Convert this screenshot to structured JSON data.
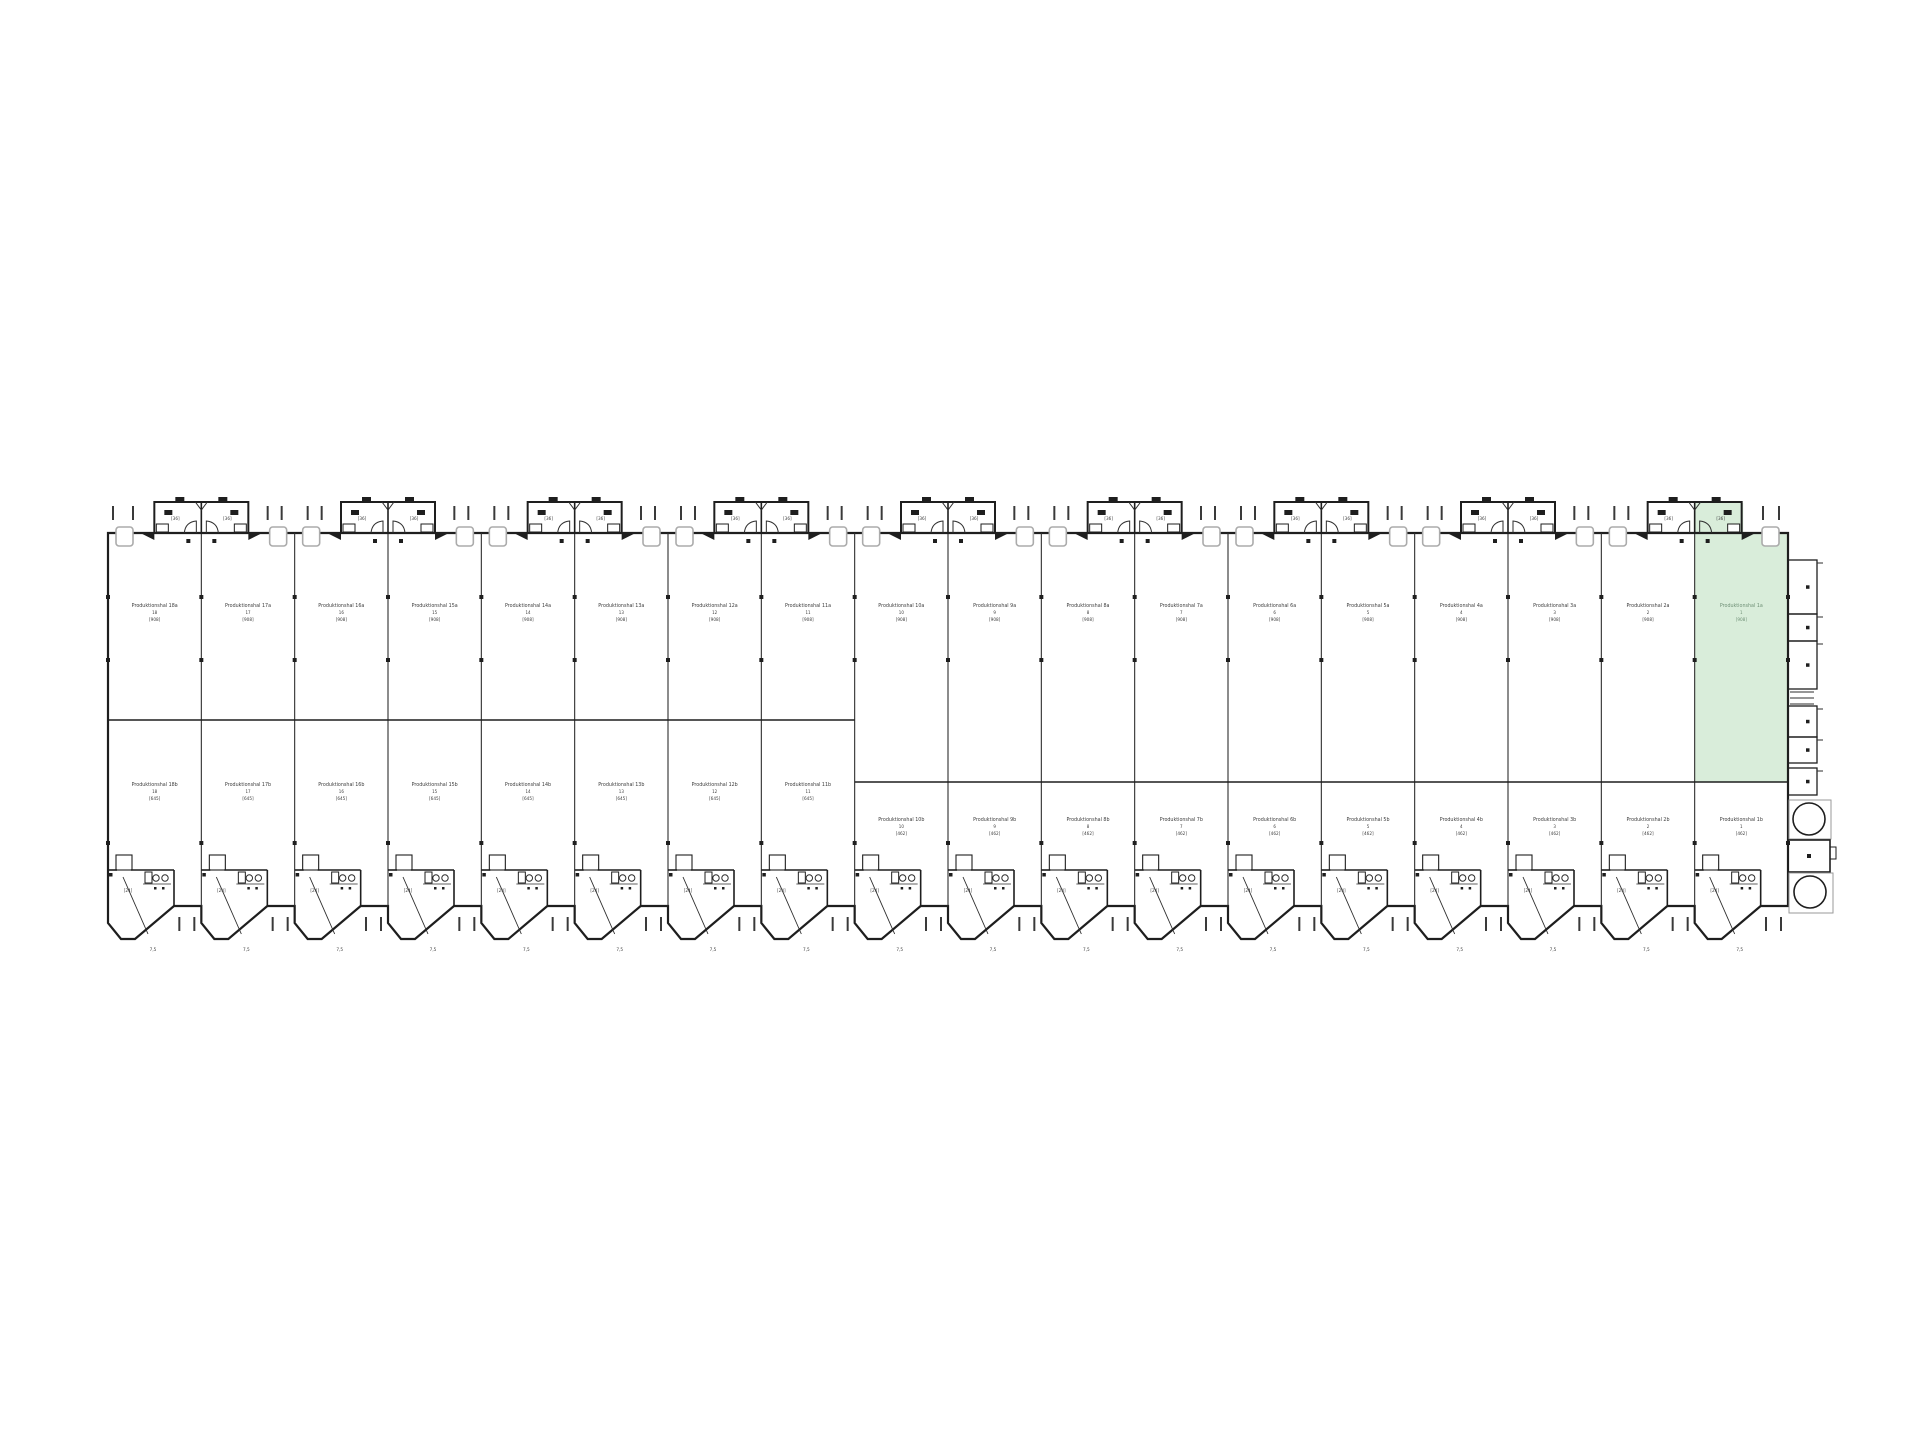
{
  "colors": {
    "line": "#1e1e1e",
    "thin": "#2e2e2e",
    "tick": "#3a3a3a",
    "canopy": "#ababab",
    "tank": "#9a9a9a",
    "text": "#3c3c3c",
    "highlight": "#d9edda",
    "highlight_text": "#6f9076",
    "background": "#ffffff"
  },
  "plan": {
    "highlighted_unit_index": 17,
    "modules": [
      {
        "left_label": "[36]",
        "right_label": "[36]"
      },
      {
        "left_label": "[36]",
        "right_label": "[36]"
      },
      {
        "left_label": "[36]",
        "right_label": "[36]"
      },
      {
        "left_label": "[36]",
        "right_label": "[36]"
      },
      {
        "left_label": "[36]",
        "right_label": "[36]"
      },
      {
        "left_label": "[36]",
        "right_label": "[36]"
      },
      {
        "left_label": "[36]",
        "right_label": "[36]"
      },
      {
        "left_label": "[36]",
        "right_label": "[36]"
      },
      {
        "left_label": "[36]",
        "right_label": "[36]"
      }
    ],
    "units": [
      {
        "top_name": "Produktionshal 18a",
        "top_no": "18",
        "top_area": "[908]",
        "bottom_name": "Produktionshal 18b",
        "bottom_no": "18",
        "bottom_area": "[645]",
        "entry_area": "[24]",
        "tip_label": "7,5"
      },
      {
        "top_name": "Produktionshal 17a",
        "top_no": "17",
        "top_area": "[908]",
        "bottom_name": "Produktionshal 17b",
        "bottom_no": "17",
        "bottom_area": "[645]",
        "entry_area": "[24]",
        "tip_label": "7,5"
      },
      {
        "top_name": "Produktionshal 16a",
        "top_no": "16",
        "top_area": "[908]",
        "bottom_name": "Produktionshal 16b",
        "bottom_no": "16",
        "bottom_area": "[645]",
        "entry_area": "[24]",
        "tip_label": "7,5"
      },
      {
        "top_name": "Produktionshal 15a",
        "top_no": "15",
        "top_area": "[908]",
        "bottom_name": "Produktionshal 15b",
        "bottom_no": "15",
        "bottom_area": "[645]",
        "entry_area": "[24]",
        "tip_label": "7,5"
      },
      {
        "top_name": "Produktionshal 14a",
        "top_no": "14",
        "top_area": "[908]",
        "bottom_name": "Produktionshal 14b",
        "bottom_no": "14",
        "bottom_area": "[645]",
        "entry_area": "[24]",
        "tip_label": "7,5"
      },
      {
        "top_name": "Produktionshal 13a",
        "top_no": "13",
        "top_area": "[908]",
        "bottom_name": "Produktionshal 13b",
        "bottom_no": "13",
        "bottom_area": "[645]",
        "entry_area": "[24]",
        "tip_label": "7,5"
      },
      {
        "top_name": "Produktionshal 12a",
        "top_no": "12",
        "top_area": "[908]",
        "bottom_name": "Produktionshal 12b",
        "bottom_no": "12",
        "bottom_area": "[645]",
        "entry_area": "[24]",
        "tip_label": "7,5"
      },
      {
        "top_name": "Produktionshal 11a",
        "top_no": "11",
        "top_area": "[908]",
        "bottom_name": "Produktionshal 11b",
        "bottom_no": "11",
        "bottom_area": "[645]",
        "entry_area": "[24]",
        "tip_label": "7,5"
      },
      {
        "top_name": "Produktionshal 10a",
        "top_no": "10",
        "top_area": "[908]",
        "bottom_name": "Produktionshal 10b",
        "bottom_no": "10",
        "bottom_area": "[462]",
        "entry_area": "[24]",
        "tip_label": "7,5"
      },
      {
        "top_name": "Produktionshal 9a",
        "top_no": "9",
        "top_area": "[908]",
        "bottom_name": "Produktionshal 9b",
        "bottom_no": "9",
        "bottom_area": "[462]",
        "entry_area": "[24]",
        "tip_label": "7,5"
      },
      {
        "top_name": "Produktionshal 8a",
        "top_no": "8",
        "top_area": "[908]",
        "bottom_name": "Produktionshal 8b",
        "bottom_no": "8",
        "bottom_area": "[462]",
        "entry_area": "[24]",
        "tip_label": "7,5"
      },
      {
        "top_name": "Produktionshal 7a",
        "top_no": "7",
        "top_area": "[908]",
        "bottom_name": "Produktionshal 7b",
        "bottom_no": "7",
        "bottom_area": "[462]",
        "entry_area": "[24]",
        "tip_label": "7,5"
      },
      {
        "top_name": "Produktionshal 6a",
        "top_no": "6",
        "top_area": "[908]",
        "bottom_name": "Produktionshal 6b",
        "bottom_no": "6",
        "bottom_area": "[462]",
        "entry_area": "[24]",
        "tip_label": "7,5"
      },
      {
        "top_name": "Produktionshal 5a",
        "top_no": "5",
        "top_area": "[908]",
        "bottom_name": "Produktionshal 5b",
        "bottom_no": "5",
        "bottom_area": "[462]",
        "entry_area": "[24]",
        "tip_label": "7,5"
      },
      {
        "top_name": "Produktionshal 4a",
        "top_no": "4",
        "top_area": "[908]",
        "bottom_name": "Produktionshal 4b",
        "bottom_no": "4",
        "bottom_area": "[462]",
        "entry_area": "[24]",
        "tip_label": "7,5"
      },
      {
        "top_name": "Produktionshal 3a",
        "top_no": "3",
        "top_area": "[908]",
        "bottom_name": "Produktionshal 3b",
        "bottom_no": "3",
        "bottom_area": "[462]",
        "entry_area": "[24]",
        "tip_label": "7,5"
      },
      {
        "top_name": "Produktionshal 2a",
        "top_no": "2",
        "top_area": "[908]",
        "bottom_name": "Produktionshal 2b",
        "bottom_no": "2",
        "bottom_area": "[462]",
        "entry_area": "[24]",
        "tip_label": "7,5"
      },
      {
        "top_name": "Produktionshal 1a",
        "top_no": "1",
        "top_area": "[908]",
        "bottom_name": "Produktionshal 1b",
        "bottom_no": "1",
        "bottom_area": "[462]",
        "entry_area": "[24]",
        "tip_label": "7,5"
      }
    ]
  }
}
